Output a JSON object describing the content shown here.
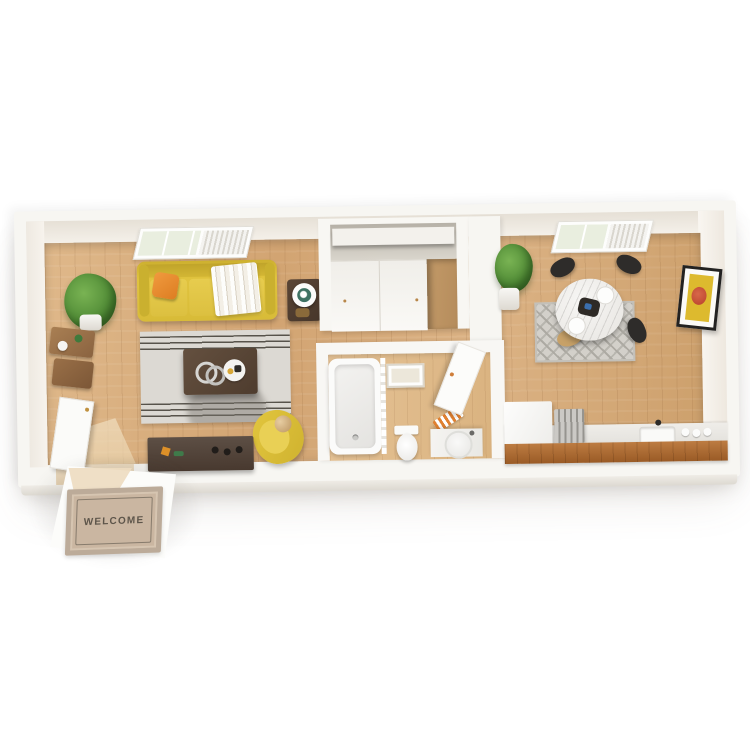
{
  "scene": {
    "type": "3d-isometric-floorplan-render",
    "background_color": "#ffffff",
    "welcome_mat": {
      "label": "WELCOME"
    },
    "rooms": [
      {
        "name": "living-room",
        "items": [
          "window-with-blinds",
          "potted-plant",
          "yellow-sofa",
          "orange-throw-pillow",
          "striped-throw-blanket",
          "side-table-with-lamp",
          "wood-bar-shelf",
          "striped-gray-area-rug",
          "dark-wood-coffee-table",
          "decor-rings",
          "decor-tray",
          "yellow-armchair",
          "media-console",
          "entry-door"
        ]
      },
      {
        "name": "closet",
        "items": [
          "upper-shelf",
          "sliding-doors",
          "open-section"
        ]
      },
      {
        "name": "bathroom",
        "items": [
          "bathtub",
          "shower-curtain",
          "wall-art",
          "toilet",
          "vanity-with-round-sink",
          "orange-striped-towels",
          "open-door"
        ]
      },
      {
        "name": "dining-area",
        "items": [
          "window-with-blinds",
          "potted-plant",
          "round-marble-dining-table",
          "black-dining-chairs",
          "wood-dining-chair",
          "chevron-rug",
          "dinner-plates",
          "dark-centerpiece-bowl",
          "framed-wall-art"
        ]
      },
      {
        "name": "kitchen",
        "items": [
          "refrigerator",
          "range",
          "countertop",
          "sink-with-faucet",
          "jars",
          "wood-front-cabinets"
        ]
      }
    ],
    "colors": {
      "wall_white": "#f7f6f2",
      "wall_interior_face": "#eee9e1",
      "floor_wood": "#d6ac7c",
      "bath_floor_wood": "#e0bc8d",
      "sofa_yellow": "#ddc03c",
      "pillow_orange": "#e8862e",
      "armchair_yellow": "#dcc13b",
      "living_rug_gray": "#dcd9d3",
      "rug_stripe_dark": "#57534b",
      "coffee_table_brown": "#5a4638",
      "console_brown": "#52453c",
      "dining_rug_gray": "#d3d0ca",
      "marble_white": "#f2f1ef",
      "chair_black": "#2e2c2a",
      "chair_wood_tan": "#c7a168",
      "kitchen_cabinet_wood": "#ab6c34",
      "art_yellow": "#ddba2e",
      "art_red": "#c34f32",
      "plant_green": "#4f8a35",
      "mat_beige": "#cab6a1",
      "mat_text": "#5d554a"
    }
  }
}
